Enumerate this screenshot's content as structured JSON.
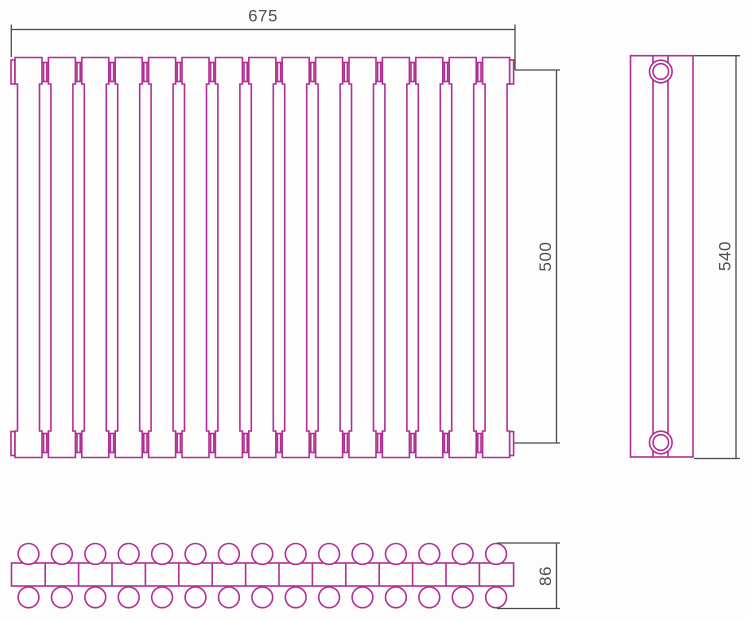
{
  "drawing": {
    "kind": "radiator technical drawing",
    "line_color": "#b12f94",
    "dimension_line_color": "#4a4a4a",
    "text_color": "#4f4f4f",
    "background_color": "#fdfdfd",
    "front_view": {
      "sections": 15,
      "connectors_per_row": 14,
      "width_label": "675",
      "connection_height_label": "500"
    },
    "side_view": {
      "height_label": "540",
      "connection_bosses": 2
    },
    "section_view": {
      "columns": 15,
      "rows": 2,
      "depth_label": "86"
    }
  },
  "dimensions": {
    "width": {
      "label": "675"
    },
    "connection_height": {
      "label": "500"
    },
    "total_height": {
      "label": "540"
    },
    "depth": {
      "label": "86"
    }
  }
}
